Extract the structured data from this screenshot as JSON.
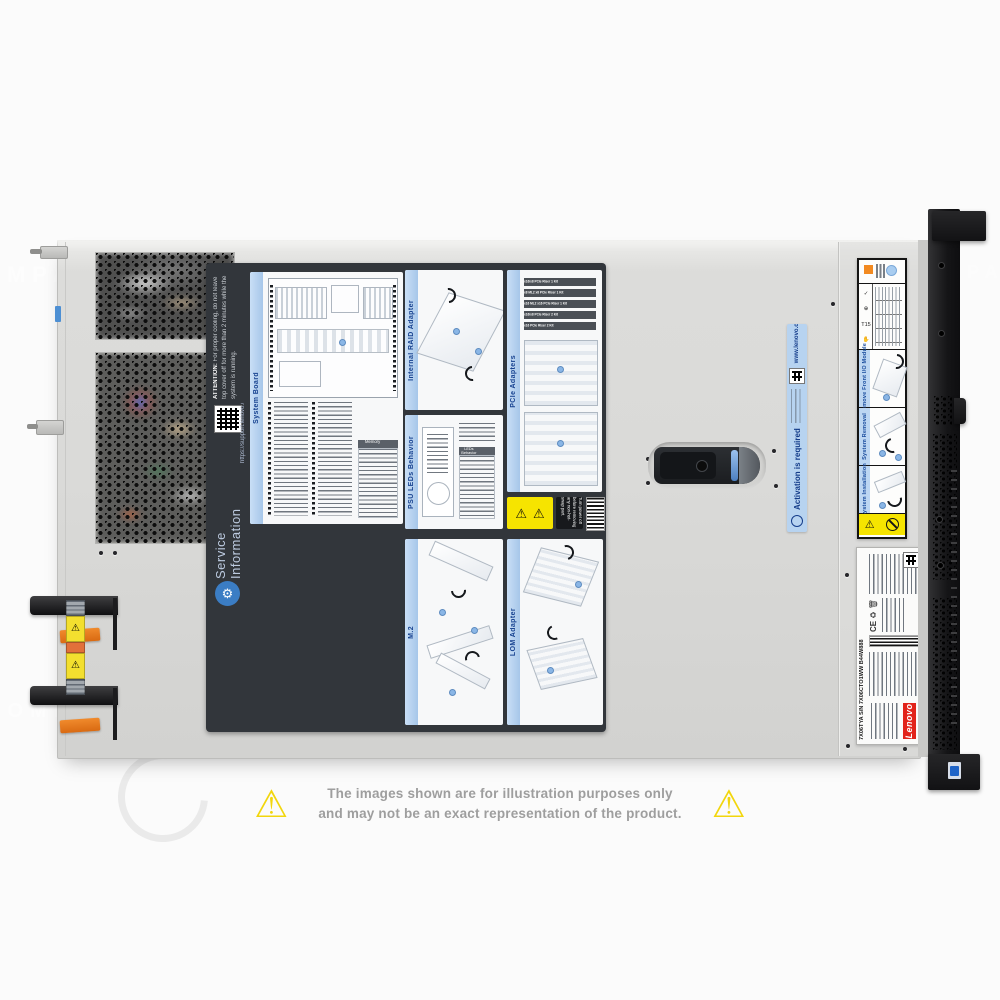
{
  "watermark": {
    "text": "COMPAN"
  },
  "service_label": {
    "attention_title": "ATTENTION:",
    "attention_body": "For proper cooling, do not leave top cover off for more than 2 minutes while the system is running.",
    "qr_caption": "https://support.lenovo.com",
    "title_line1": "Service",
    "title_line2": "Information",
    "panels": {
      "system_board": "System Board",
      "internal_raid": "Internal RAID Adapter",
      "pcie": "PCIe Adapters",
      "psu_leds": "PSU LEDs Behavior",
      "m2": "M.2",
      "lom": "LOM Adapter"
    },
    "memory_header": "Memory",
    "psu_table_header": "LEDs Behavior",
    "riser_kits": [
      "x16/x8 PCIe Riser 1 Kit",
      "x8 ML2 x8 PCIe Riser 1 Kit",
      "x16 ML2 x16 PCIe Riser 1 Kit",
      "x16/x8 PCIe Riser 2 Kit",
      "x16 PCIe Riser 2 Kit"
    ],
    "warning_note": "Turn power off before removing any non-hot-swap part."
  },
  "activation_strip": {
    "title": "Activation is required",
    "url": "www.lenovo.com/activate"
  },
  "io_label": {
    "panel1": "Remove Front I/O Module",
    "panel2": "System Removal",
    "panel3": "System Installation"
  },
  "regulatory_label": {
    "brand": "Lenovo",
    "model_line": "7X06TYA S/N 7X06CTO1WW B44W888",
    "ce_mark": "CE"
  },
  "disclaimer": {
    "line1": "The images shown are for illustration purposes only",
    "line2": "and may not be an exact representation of the product."
  },
  "colors": {
    "chassis": "#d9d9d7",
    "label_dark": "#32363b",
    "panel_header_blue": "#b9d3ee",
    "activation_blue": "#b7d3f0",
    "warning_yellow": "#f6e400",
    "psu_tab_orange": "#e07820",
    "lenovo_red": "#e2231a"
  }
}
